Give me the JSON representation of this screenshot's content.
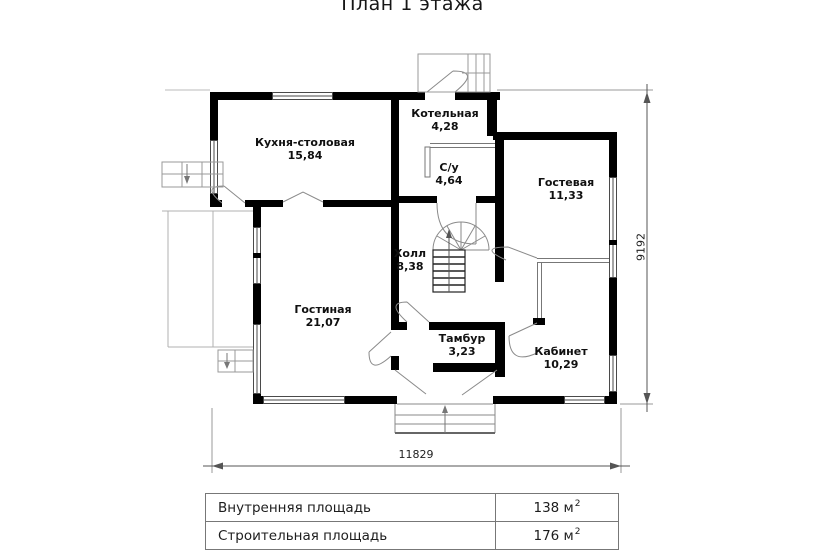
{
  "title": "План 1 этажа",
  "rooms": [
    {
      "name": "Кухня-столовая",
      "area": "15,84"
    },
    {
      "name": "Котельная",
      "area": "4,28"
    },
    {
      "name": "С/у",
      "area": "4,64"
    },
    {
      "name": "Гостевая",
      "area": "11,33"
    },
    {
      "name": "Холл",
      "area": "8,38"
    },
    {
      "name": "Гостиная",
      "area": "21,07"
    },
    {
      "name": "Тамбур",
      "area": "3,23"
    },
    {
      "name": "Кабинет",
      "area": "10,29"
    }
  ],
  "dimensions": {
    "bottom": "11829",
    "right": "9192"
  },
  "summary_table": {
    "rows": [
      {
        "label": "Внутренняя площадь",
        "value": "138 м",
        "sup": "2"
      },
      {
        "label": "Строительная площадь",
        "value": "176 м",
        "sup": "2"
      }
    ]
  },
  "colors": {
    "wall": "#000000",
    "thin_line": "#808080",
    "text": "#1a1a1a",
    "background": "#ffffff"
  }
}
